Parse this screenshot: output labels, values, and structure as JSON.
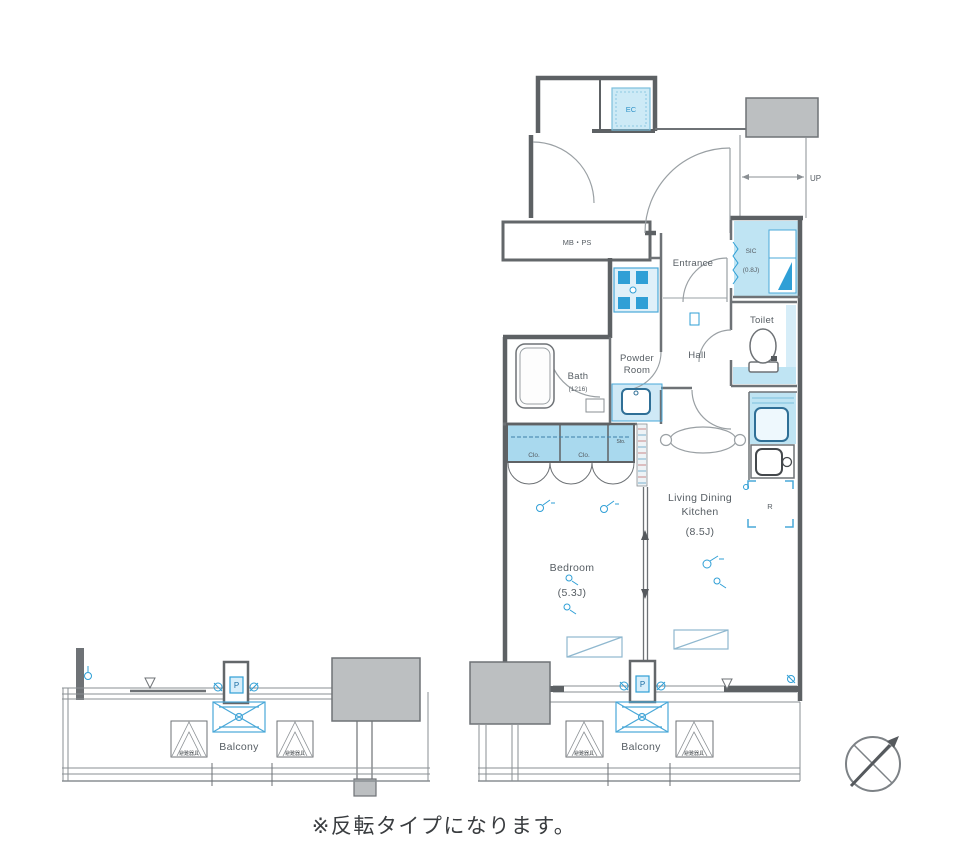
{
  "floorplan": {
    "caption": "※反転タイプになります。",
    "rooms": {
      "ec": "EC",
      "mbps": "MB・PS",
      "up": "UP",
      "entrance": "Entrance",
      "sic": "SIC",
      "sic_size": "(0.8J)",
      "toilet": "Toilet",
      "hall": "Hall",
      "powder1": "Powder",
      "powder2": "Room",
      "bath": "Bath",
      "bath_size": "(1216)",
      "clo1": "Clo.",
      "clo2": "Clo.",
      "sto": "Sto.",
      "ldk1": "Living Dining",
      "ldk2": "Kitchen",
      "ldk_size": "(8.5J)",
      "bedroom": "Bedroom",
      "bedroom_size": "(5.3J)",
      "fridge": "R",
      "pillar": "P",
      "balcony": "Balcony",
      "hatch_note": "避難器具"
    },
    "colors": {
      "wall_gray": "#5d6164",
      "light_blue": "#bfe4f3",
      "accent_blue": "#2f9fd6",
      "box_gray": "#bcbfc1"
    }
  }
}
